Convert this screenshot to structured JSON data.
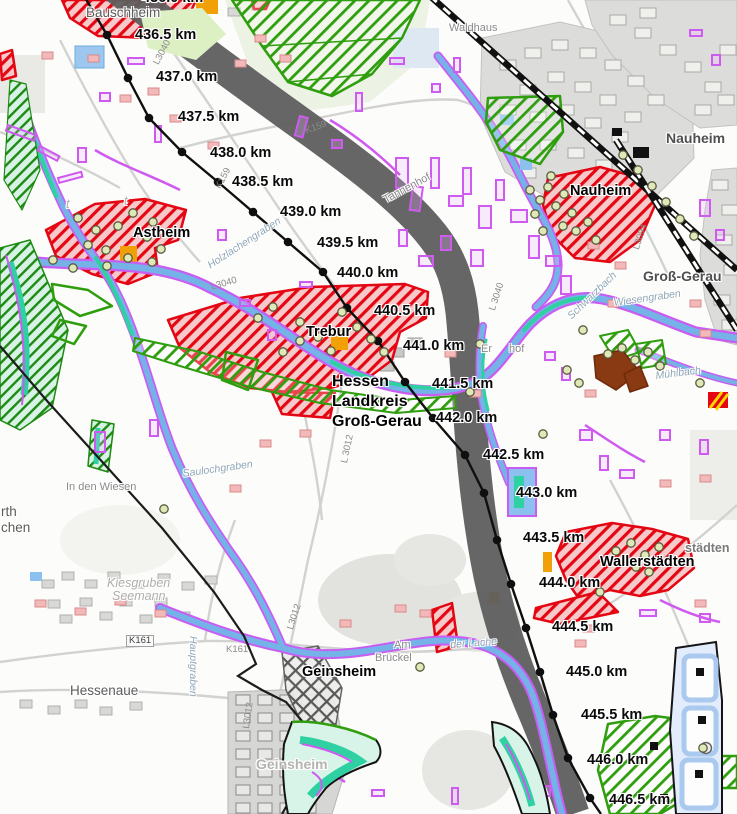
{
  "map": {
    "route_km": [
      {
        "km": "436.0 km",
        "node": [
          83,
          -6
        ],
        "label": [
          142,
          -9
        ]
      },
      {
        "km": "436.5 km",
        "node": [
          107,
          35
        ],
        "label": [
          135,
          28
        ]
      },
      {
        "km": "437.0 km",
        "node": [
          128,
          78
        ],
        "label": [
          156,
          70
        ]
      },
      {
        "km": "437.5 km",
        "node": [
          149,
          118
        ],
        "label": [
          178,
          110
        ]
      },
      {
        "km": "438.0 km",
        "node": [
          182,
          152
        ],
        "label": [
          210,
          146
        ]
      },
      {
        "km": "438.5 km",
        "node": [
          218,
          182
        ],
        "label": [
          232,
          175
        ]
      },
      {
        "km": "439.0 km",
        "node": [
          253,
          212
        ],
        "label": [
          280,
          205
        ]
      },
      {
        "km": "439.5 km",
        "node": [
          288,
          242
        ],
        "label": [
          317,
          236
        ]
      },
      {
        "km": "440.0 km",
        "node": [
          323,
          272
        ],
        "label": [
          337,
          266
        ]
      },
      {
        "km": "440.5 km",
        "node": [
          347,
          308
        ],
        "label": [
          374,
          304
        ]
      },
      {
        "km": "441.0 km",
        "node": [
          378,
          341
        ],
        "label": [
          403,
          339
        ]
      },
      {
        "km": "441.5 km",
        "node": [
          405,
          382
        ],
        "label": [
          432,
          377
        ]
      },
      {
        "km": "442.0 km",
        "node": [
          433,
          418
        ],
        "label": [
          436,
          411
        ]
      },
      {
        "km": "442.5 km",
        "node": [
          465,
          455
        ],
        "label": [
          483,
          448
        ]
      },
      {
        "km": "443.0 km",
        "node": [
          484,
          493
        ],
        "label": [
          516,
          486
        ]
      },
      {
        "km": "443.5 km",
        "node": [
          497,
          540
        ],
        "label": [
          523,
          531
        ]
      },
      {
        "km": "444.0 km",
        "node": [
          511,
          584
        ],
        "label": [
          539,
          576
        ]
      },
      {
        "km": "444.5 km",
        "node": [
          526,
          628
        ],
        "label": [
          552,
          620
        ]
      },
      {
        "km": "445.0 km",
        "node": [
          540,
          672
        ],
        "label": [
          566,
          665
        ]
      },
      {
        "km": "445.5 km",
        "node": [
          553,
          715
        ],
        "label": [
          581,
          708
        ]
      },
      {
        "km": "446.0 km",
        "node": [
          568,
          758
        ],
        "label": [
          587,
          753
        ]
      },
      {
        "km": "446.5 km",
        "node": [
          590,
          798
        ],
        "label": [
          609,
          793
        ]
      }
    ],
    "labels": [
      {
        "t": "Bauschheim",
        "x": 86,
        "y": 6,
        "c": "town"
      },
      {
        "t": "Waldhaus",
        "x": 449,
        "y": 23,
        "c": "hamlet"
      },
      {
        "t": "Nauheim",
        "x": 666,
        "y": 131,
        "c": "town-bold"
      },
      {
        "t": "Nauheim",
        "x": 570,
        "y": 184,
        "c": "place"
      },
      {
        "t": "Groß-Gerau",
        "x": 643,
        "y": 269,
        "c": "town-bold"
      },
      {
        "t": "Astheim",
        "x": 133,
        "y": 226,
        "c": "place"
      },
      {
        "t": "Trebur",
        "x": 306,
        "y": 325,
        "c": "place"
      },
      {
        "t": "Hessen",
        "x": 332,
        "y": 374,
        "c": "admin"
      },
      {
        "t": "Landkreis",
        "x": 332,
        "y": 394,
        "c": "admin"
      },
      {
        "t": "Groß-Gerau",
        "x": 332,
        "y": 414,
        "c": "admin"
      },
      {
        "t": "Wallerstädten",
        "x": 600,
        "y": 555,
        "c": "place"
      },
      {
        "t": "städten",
        "x": 685,
        "y": 542,
        "c": "town-sm"
      },
      {
        "t": "Geinsheim",
        "x": 302,
        "y": 665,
        "c": "place"
      },
      {
        "t": "Geinsheim",
        "x": 256,
        "y": 757,
        "c": "town-faded"
      },
      {
        "t": "Hessenaue",
        "x": 70,
        "y": 684,
        "c": "town"
      },
      {
        "t": "In den Wiesen",
        "x": 66,
        "y": 482,
        "c": "hamlet"
      },
      {
        "t": "Kiesgruben",
        "x": 107,
        "y": 577,
        "c": "faded-i"
      },
      {
        "t": "Seemann",
        "x": 112,
        "y": 590,
        "c": "faded-i"
      },
      {
        "t": "Tannenhof",
        "x": 382,
        "y": 196,
        "c": "hamlet",
        "r": -28
      },
      {
        "t": "Er",
        "x": 481,
        "y": 344,
        "c": "hamlet"
      },
      {
        "t": "hof",
        "x": 509,
        "y": 344,
        "c": "hamlet"
      },
      {
        "t": "Am",
        "x": 394,
        "y": 640,
        "c": "hamlet"
      },
      {
        "t": "Brückel",
        "x": 375,
        "y": 653,
        "c": "hamlet"
      },
      {
        "t": "Saulochgraben",
        "x": 182,
        "y": 469,
        "c": "water",
        "r": -8
      },
      {
        "t": "Hauptgraben",
        "x": 198,
        "y": 636,
        "c": "water",
        "r": 90
      },
      {
        "t": "Holzlachengraben",
        "x": 206,
        "y": 262,
        "c": "water",
        "r": -33
      },
      {
        "t": "Schwarzbach",
        "x": 566,
        "y": 314,
        "c": "water",
        "r": -44
      },
      {
        "t": "Wiesengraben",
        "x": 613,
        "y": 298,
        "c": "water",
        "r": -8
      },
      {
        "t": "Mühlbach",
        "x": 655,
        "y": 371,
        "c": "water",
        "r": -7
      },
      {
        "t": "der Lache",
        "x": 450,
        "y": 640,
        "c": "water",
        "r": -4
      },
      {
        "t": "K161",
        "x": 126,
        "y": 635,
        "c": "road-box"
      },
      {
        "t": "K161",
        "x": 226,
        "y": 645,
        "c": "road"
      },
      {
        "t": "K159",
        "x": 214,
        "y": 186,
        "c": "road",
        "r": -62
      },
      {
        "t": "K159",
        "x": 304,
        "y": 127,
        "c": "road",
        "r": -20
      },
      {
        "t": "L3040",
        "x": 152,
        "y": 62,
        "c": "road",
        "r": -62
      },
      {
        "t": "L3040",
        "x": 210,
        "y": 283,
        "c": "road",
        "r": -16
      },
      {
        "t": "L 3040",
        "x": 488,
        "y": 309,
        "c": "road",
        "r": -72
      },
      {
        "t": "L 3012",
        "x": 340,
        "y": 462,
        "c": "road",
        "r": -78
      },
      {
        "t": "L3012",
        "x": 286,
        "y": 628,
        "c": "road",
        "r": -72
      },
      {
        "t": "L3012",
        "x": 242,
        "y": 728,
        "c": "road",
        "r": -82
      },
      {
        "t": "L3094",
        "x": 632,
        "y": 248,
        "c": "road",
        "r": -72
      },
      {
        "t": "rth",
        "x": 1,
        "y": 505,
        "c": "town"
      },
      {
        "t": "chen",
        "x": 1,
        "y": 521,
        "c": "town"
      },
      {
        "t": "t",
        "x": 66,
        "y": 198,
        "c": "faded-i"
      },
      {
        "t": "t",
        "x": 124,
        "y": 195,
        "c": "faded-i"
      }
    ],
    "colors": {
      "route_band": "#5e5e5e",
      "km_line": "#0f0f0f",
      "boundary": "#1c1c1c",
      "railway": "#111111",
      "red_hatch": "#e40613",
      "red_fill": "#f6caca",
      "green_hatch": "#2f9e0e",
      "dark_green": "#1d8a12",
      "teal": "#2fd1a3",
      "purple_biotope": "#cf5af0",
      "water_blue": "#74b2e8",
      "orange": "#f2a007",
      "settlement_gray": "#dcdcda",
      "marker_fill": "#dfe9b8"
    }
  }
}
